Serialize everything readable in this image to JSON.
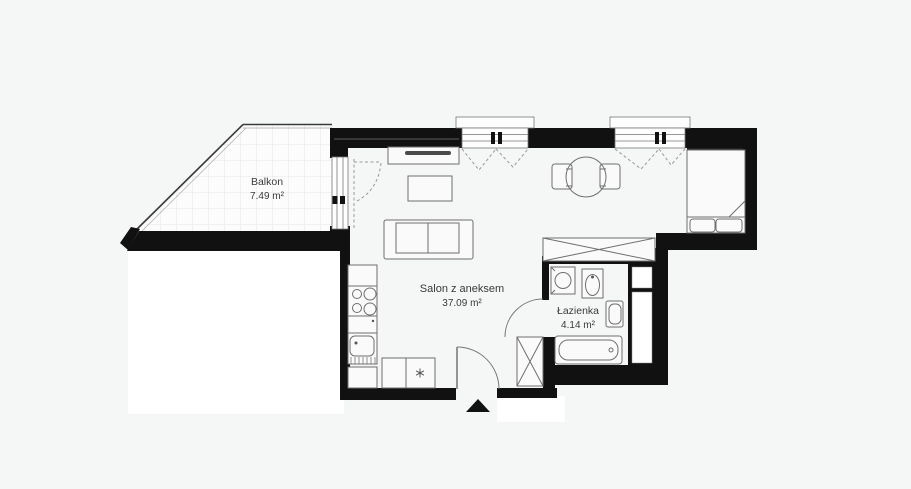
{
  "floorplan": {
    "background_color": "#f5f6f6",
    "wall_color": "#111111",
    "furniture_line_color": "#6f6f6f",
    "adjacent_area_color": "#ffffff",
    "rooms": [
      {
        "name": "Balkon",
        "area": "7.49 m²"
      },
      {
        "name": "Salon z aneksem",
        "area": "37.09 m²"
      },
      {
        "name": "Łazienka",
        "area": "4.14 m²"
      }
    ],
    "icons": {
      "fridge": "snowflake",
      "entrance": "up-triangle-arrow"
    }
  }
}
